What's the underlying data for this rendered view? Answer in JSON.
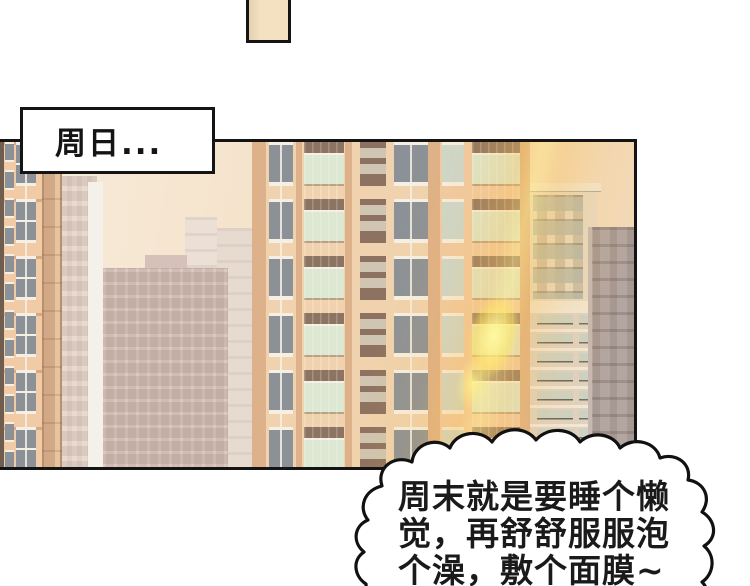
{
  "caption": {
    "text": "周日..."
  },
  "bubble": {
    "lines": [
      "周末就是要睡个懒",
      "觉，再舒舒服服泡",
      "个澡，敷个面膜~"
    ]
  },
  "palette": {
    "paper": "#ffffff",
    "ink": "#141414",
    "prev_panel_fill": "#f3e1c2",
    "sky_left": "#f8ecdc",
    "sky_right": "#f2d9b6",
    "facade_peach": "#f0cba6",
    "facade_peach_light": "#f0d3ae",
    "pilaster_tan": "#ddb189",
    "tower_tan": "#d2a987",
    "tower_tan_light": "#e6c49e",
    "tower_tan_dark": "#b98f6e",
    "panel_brown": "#8d7261",
    "panel_slit": "#cfc5b2",
    "window_frame": "#f6f0e4",
    "window_glass": "#8b9197",
    "window_glass_pale": "#ccd8cf",
    "balcony_glass_green": "#dce8d2",
    "spandrel_brown": "#8c7362",
    "haze_light": "#e9d9cf",
    "haze_white": "#f4f0ea",
    "haze_pink": "#dcc8c0",
    "haze_pink_dark": "#d5c1b9",
    "haze_tower": "#ece0d6",
    "haze_tower2": "#e7dacf",
    "beige_building": "#e8dac2",
    "beige_trim": "#f1e6d1",
    "beige_window": "#ccd2c5",
    "beige_floor": "#efe8db",
    "beige_wall": "#e0d2c0",
    "gray_building": "#b3a59f",
    "gray_building_light": "#c6b9b1",
    "glare_orange": "#f8b042",
    "glare_yellow": "#ffe278",
    "bubble_fill": "#ffffff",
    "bubble_stroke": "#111111"
  }
}
